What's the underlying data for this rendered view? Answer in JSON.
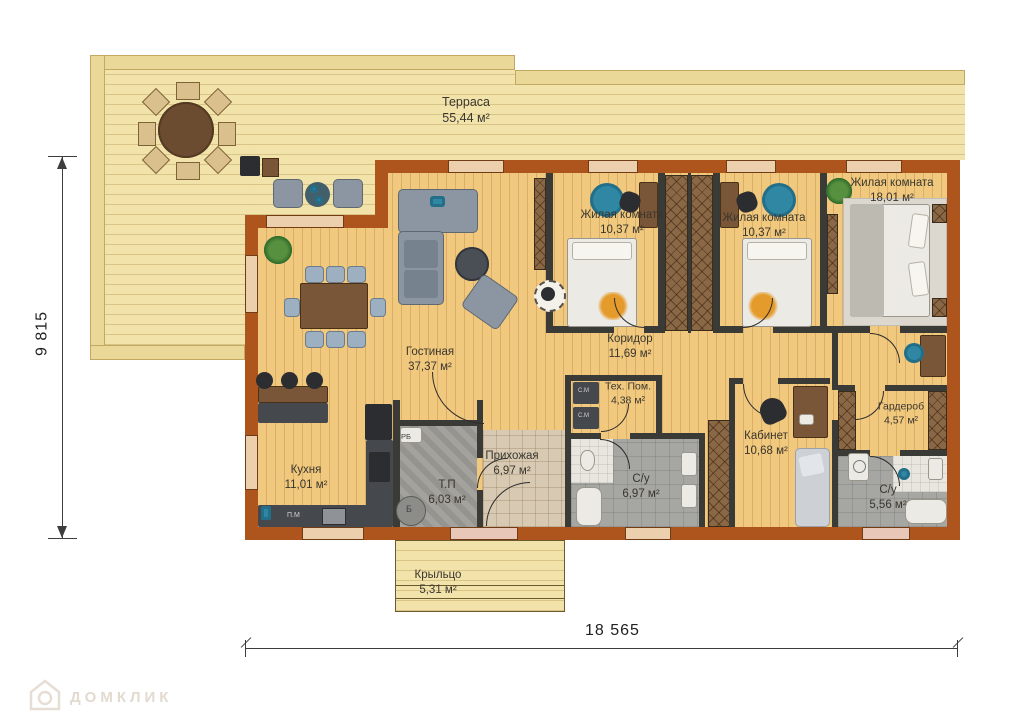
{
  "plan": {
    "rooms": [
      {
        "name": "Терраса",
        "area": "55,44 м²"
      },
      {
        "name": "Гостиная",
        "area": "37,37 м²"
      },
      {
        "name": "Кухня",
        "area": "11,01 м²"
      },
      {
        "name": "Жилая комната",
        "area": "10,37 м²"
      },
      {
        "name": "Жилая комната",
        "area": "10,37 м²"
      },
      {
        "name": "Жилая комната",
        "area": "18,01 м²"
      },
      {
        "name": "Коридор",
        "area": "11,69 м²"
      },
      {
        "name": "Тех. Пом.",
        "area": "4,38 м²"
      },
      {
        "name": "Т.П",
        "area": "6,03 м²"
      },
      {
        "name": "Прихожая",
        "area": "6,97 м²"
      },
      {
        "name": "С/у",
        "area": "6,97 м²"
      },
      {
        "name": "Кабинет",
        "area": "10,68 м²"
      },
      {
        "name": "Гардероб",
        "area": "4,57 м²"
      },
      {
        "name": "С/у",
        "area": "5,56 м²"
      },
      {
        "name": "Крыльцо",
        "area": "5,31 м²"
      }
    ],
    "annotations": {
      "rb": "РБ",
      "b": "Б",
      "pm": "П.М",
      "sm1": "С.М",
      "sm2": "С.М"
    },
    "dimensions": {
      "height": "9 815",
      "width": "18 565"
    },
    "watermark": {
      "text": "ДОМКЛИК"
    },
    "colors": {
      "wall": "#ae541d",
      "terrace": "#f2e3ab",
      "floor": "#f0c87e",
      "partition": "#3a3a36",
      "accent_teal": "#2f87a3"
    }
  }
}
